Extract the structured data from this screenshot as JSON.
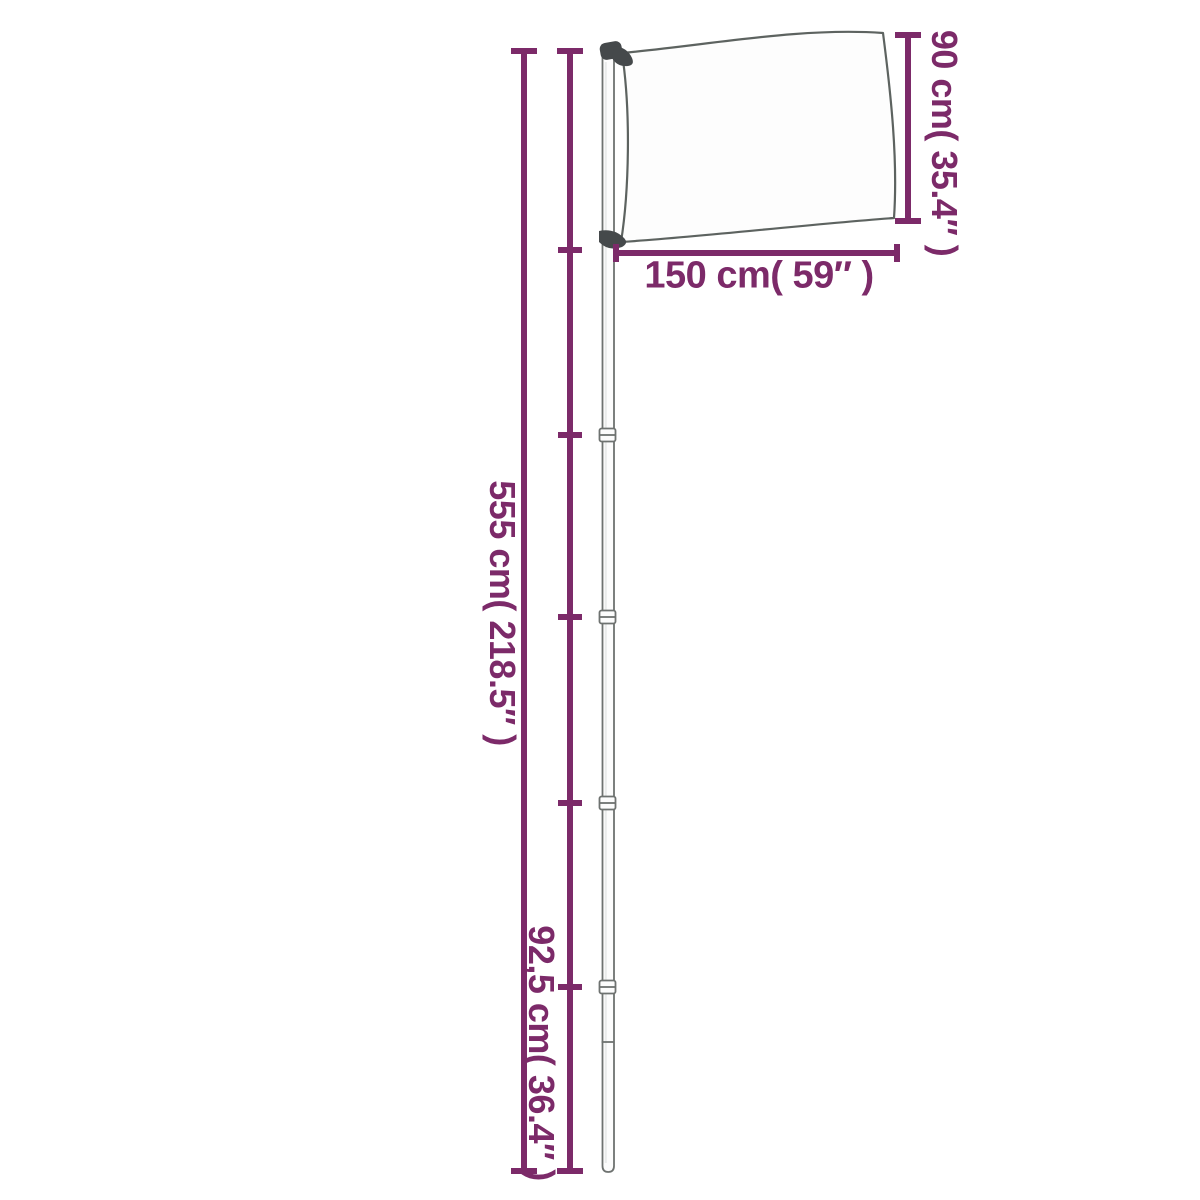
{
  "page": {
    "background": "#ffffff"
  },
  "colors": {
    "dimension": "#7c2a69",
    "pole_outline": "#6e7270",
    "pole_fill": "#fcfcfc",
    "flag_outline": "#5d6360",
    "flag_fill": "#fdfdfd",
    "hardware": "#45494b",
    "background": "#ffffff"
  },
  "diagram": {
    "type": "product-dimension-diagram",
    "subject": "telescopic flagpole with flag",
    "dimensions": {
      "pole_height": {
        "label": "555 cm( 218.5″ )",
        "value_cm": 555,
        "value_in": 218.5
      },
      "bottom_segment": {
        "label": "92,5 cm( 36.4″ )",
        "value_cm": 92.5,
        "value_in": 36.4
      },
      "flag_width": {
        "label": "150 cm( 59″ )",
        "value_cm": 150,
        "value_in": 59
      },
      "flag_height": {
        "label": "90 cm( 35.4″ )",
        "value_cm": 90,
        "value_in": 35.4
      }
    }
  }
}
